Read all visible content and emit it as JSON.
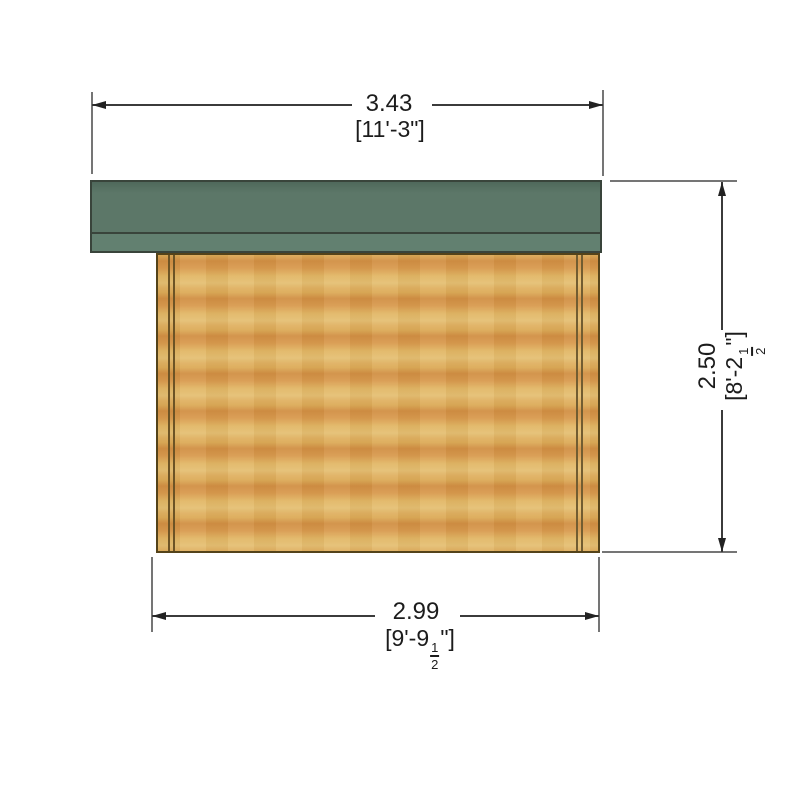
{
  "figure": {
    "type": "technical elevation drawing",
    "subject": "timber log cabin side elevation with pent roof overhang"
  },
  "colors": {
    "background": "#ffffff",
    "roof": "#5c7768",
    "roof_fascia": "#628070",
    "roof_outline": "#39443b",
    "wood_light": "#e5c074",
    "wood_dark": "#d18f44",
    "wood_outline": "#54431a",
    "dimension_line": "#3b3b3b",
    "text": "#1c1c1c"
  },
  "dimensions": {
    "top_width": {
      "metric_m": "3.43",
      "imperial": "[11'-3\"]"
    },
    "bottom_width": {
      "metric_m": "2.99",
      "imperial_open": "[9'-9",
      "fraction": {
        "num": "1",
        "den": "2"
      },
      "imperial_close": "\"]"
    },
    "right_height": {
      "metric_m": "2.50",
      "imperial_open": "[8'-2",
      "fraction": {
        "num": "1",
        "den": "2"
      },
      "imperial_close": "\"]"
    }
  }
}
